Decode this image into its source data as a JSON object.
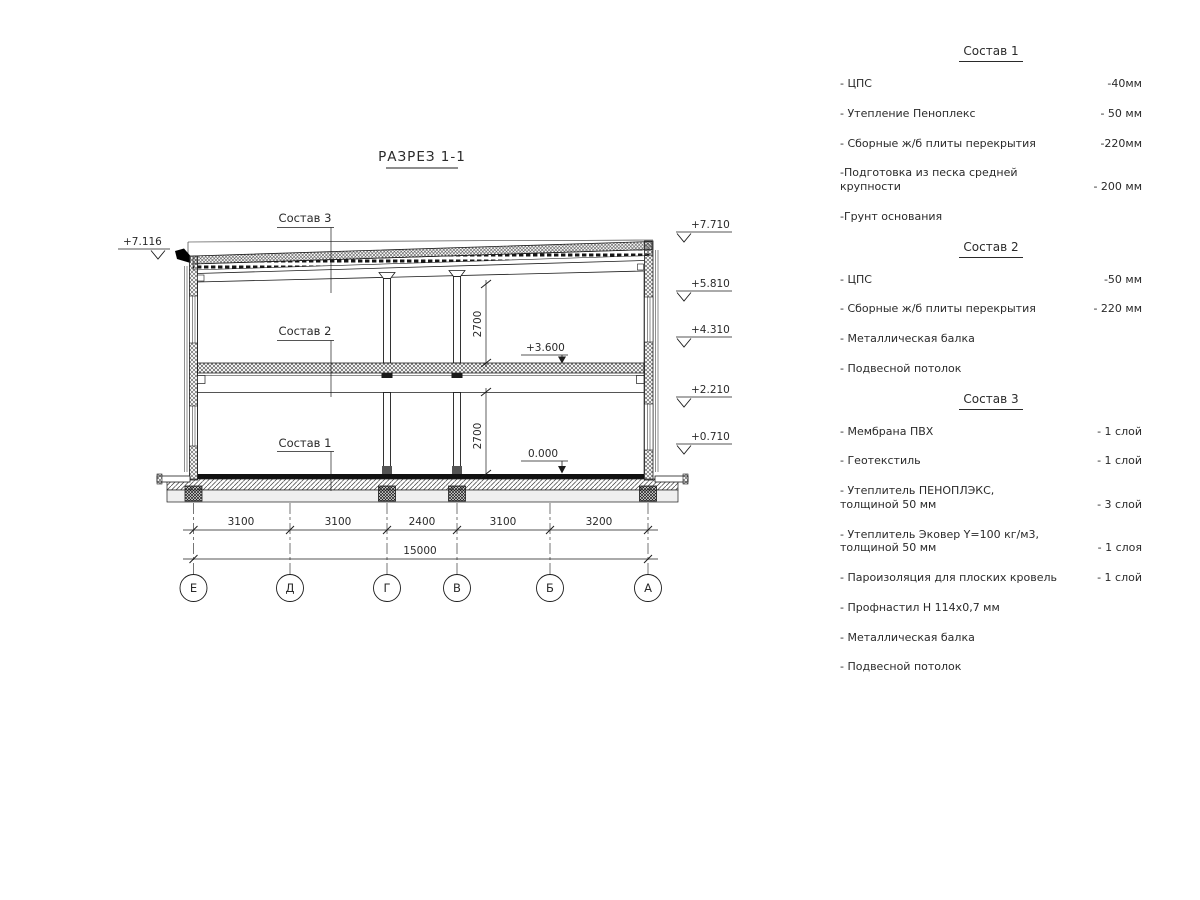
{
  "drawing": {
    "title": "РАЗРЕЗ 1-1",
    "composition_labels": [
      "Состав 3",
      "Состав 2",
      "Состав 1"
    ],
    "elevation_marks": {
      "left": "+7.116",
      "right": [
        "+7.710",
        "+5.810",
        "+4.310",
        "+2.210",
        "+0.710"
      ],
      "floor_marks": [
        "+3.600",
        "0.000"
      ]
    },
    "room_heights": [
      "2700",
      "2700"
    ],
    "span_dimensions": [
      "3100",
      "3100",
      "2400",
      "3100",
      "3200"
    ],
    "total_dimension": "15000",
    "axes": [
      "Е",
      "Д",
      "Г",
      "В",
      "Б",
      "А"
    ]
  },
  "legend": {
    "sections": [
      {
        "title": "Состав 1",
        "items": [
          {
            "name": "- ЦПС",
            "value": "-40мм"
          },
          {
            "name": "- Утепление Пеноплекс",
            "value": "- 50 мм"
          },
          {
            "name": "- Сборные ж/б плиты перекрытия",
            "value": "-220мм"
          },
          {
            "name": "-Подготовка из песка средней\nкрупности",
            "value": "- 200 мм"
          },
          {
            "name": "-Грунт основания",
            "value": ""
          }
        ]
      },
      {
        "title": "Состав 2",
        "items": [
          {
            "name": "- ЦПС",
            "value": "-50 мм"
          },
          {
            "name": "- Сборные ж/б плиты перекрытия",
            "value": "- 220 мм"
          },
          {
            "name": "- Металлическая балка",
            "value": ""
          },
          {
            "name": "- Подвесной потолок",
            "value": ""
          }
        ]
      },
      {
        "title": "Состав 3",
        "items": [
          {
            "name": "- Мембрана ПВХ",
            "value": "- 1 слой"
          },
          {
            "name": "- Геотекстиль",
            "value": "- 1 слой"
          },
          {
            "name": "- Утеплитель ПЕНОПЛЭКС,\nтолщиной 50 мм",
            "value": "- 3 слой"
          },
          {
            "name": "- Утеплитель Эковер Y=100 кг/м3,\nтолщиной 50 мм",
            "value": "- 1 слоя"
          },
          {
            "name": "- Пароизоляция для плоских кровель",
            "value": "- 1 слой"
          },
          {
            "name": "- Профнастил Н 114х0,7 мм",
            "value": ""
          },
          {
            "name": "- Металлическая балка",
            "value": ""
          },
          {
            "name": "- Подвесной потолок",
            "value": ""
          }
        ]
      }
    ]
  }
}
